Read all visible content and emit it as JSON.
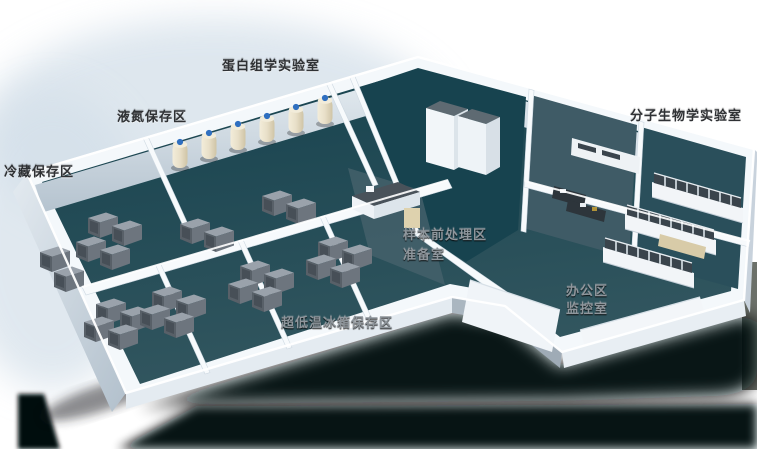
{
  "labels": {
    "proteomics_lab": "蛋白组学实验室",
    "liquid_nitrogen_area": "液氮保存区",
    "cold_storage_area": "冷藏保存区",
    "molecular_biology_lab": "分子生物学实验室",
    "sample_pretreatment_area": "样本前处理区",
    "preparation_room": "准备室",
    "office_area": "办公区",
    "monitoring_room": "监控室",
    "ultralow_freezer_area": "超低温冰箱保存区"
  },
  "colors": {
    "floor_teal": "#1d4a55",
    "floor_teal_light": "#3f5b66",
    "wall_light": "#f2f6f9",
    "wall_shade": "#c6d2db",
    "shadow_black": "#04070a",
    "haze_blue": "#d3dfe9",
    "label_dark": "#2f3134",
    "label_light": "#8f969c",
    "dewar_cream": "#e8dfc8",
    "dewar_cap_blue": "#2f6fc0",
    "freezer_gray": "#5d656d",
    "glass_dark": "#3a444c",
    "bench_tan": "#d8cba8"
  }
}
